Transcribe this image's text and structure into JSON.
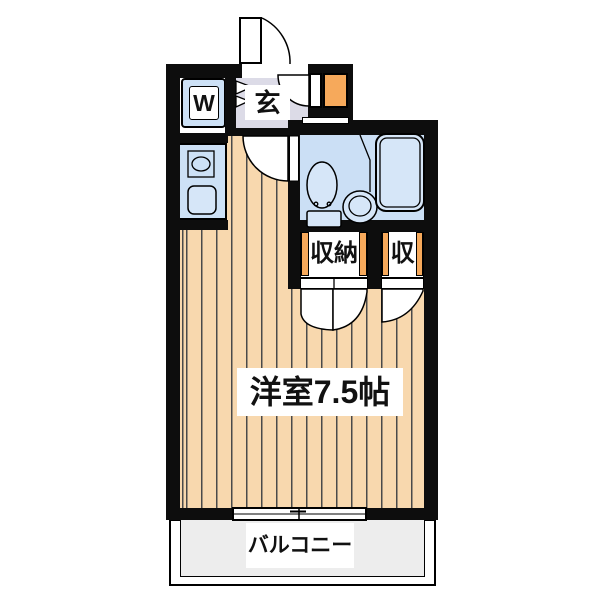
{
  "title": "ワンルーム間取り図",
  "labels": {
    "washing_machine": "W",
    "entrance": "玄",
    "closet_large": "収納",
    "closet_small": "収",
    "main_room": "洋室7.5帖",
    "balcony": "バルコニー"
  },
  "rooms": [
    {
      "name": "entrance-hall",
      "label": "玄"
    },
    {
      "name": "washing-machine-space",
      "label": "W"
    },
    {
      "name": "kitchen",
      "label": ""
    },
    {
      "name": "unit-bathroom",
      "label": ""
    },
    {
      "name": "closet-large",
      "label": "収納"
    },
    {
      "name": "closet-small",
      "label": "収"
    },
    {
      "name": "western-room",
      "label": "洋室7.5帖",
      "size_jo": 7.5
    },
    {
      "name": "balcony",
      "label": "バルコニー"
    }
  ],
  "colors": {
    "wall": "#0d0d0d",
    "floor": "#f8d8ae",
    "floor_line": "#4a4a4a",
    "water_blue": "#cde1f6",
    "bathroom_blue": "#cbdff5",
    "fixture_blue": "#d6e6f8",
    "genkan_gray": "#dcdbe7",
    "accent_orange": "#f6a95b",
    "balcony_gray": "#ededed",
    "label_ink": "#111111"
  }
}
